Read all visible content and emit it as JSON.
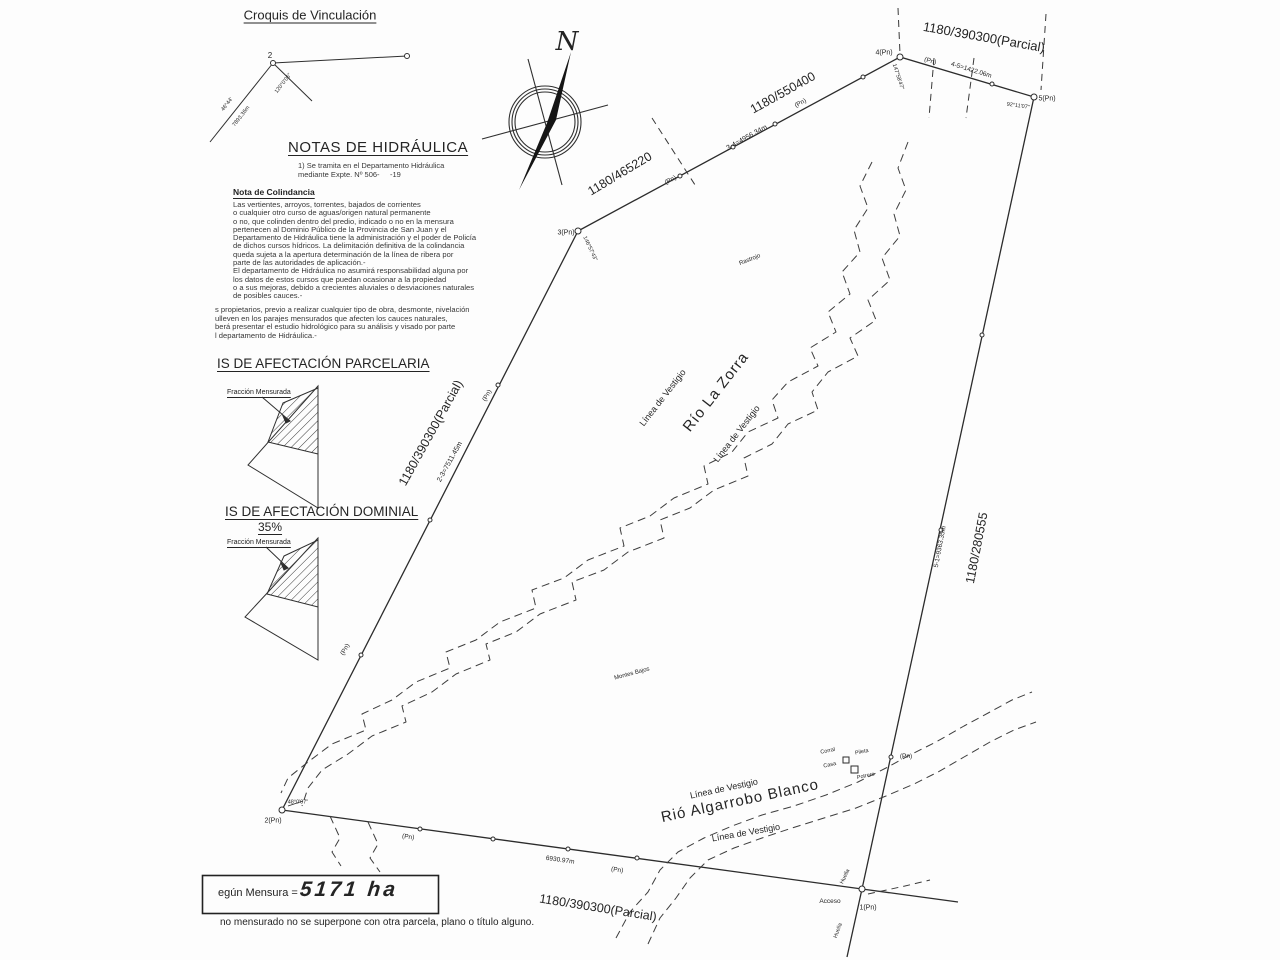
{
  "croquis": {
    "title": "Croquis de Vinculación",
    "vertex": "2",
    "angle_branch": "120°0'06\"",
    "angle_left": "46°44'",
    "distance": "7893.36m"
  },
  "notas": {
    "title": "NOTAS DE HIDRÁULICA",
    "item1": "1) Se tramita en el Departamento Hidráulica\nmediante Expte. Nº 506-     -19",
    "colindancia_title": "Nota de Colindancia",
    "paragraph1": "Las vertientes, arroyos, torrentes, bajados de corrientes\no cualquier otro curso de aguas/origen natural permanente\no no, que colinden dentro del predio, indicado o no en la mensura\npertenecen al Dominio Público de la Provincia de San Juan y el\nDepartamento de Hidráulica tiene la administración y el poder de Policía\nde dichos cursos hídricos. La delimitación definitiva de la colindancia\nqueda sujeta a la apertura determinación de la línea de ribera por\nparte de las autoridades de aplicación.-\nEl departamento de Hidráulica no asumirá responsabilidad alguna por\nlos datos de estos cursos que puedan ocasionar a la propiedad\no a sus mejoras, debido a crecientes aluviales o desviaciones naturales\nde posibles cauces.-",
    "paragraph2": "s propietarios, previo a realizar cualquier tipo de obra, desmonte, nivelación\nulleven en los parajes mensurados que afecten los cauces naturales,\nberá presentar el estudio hidrológico para su análisis y visado por parte\nl departamento de Hidráulica.-"
  },
  "parcelaria": {
    "title": "IS DE AFECTACIÓN PARCELARIA",
    "fraccion": "Fracción Mensurada"
  },
  "dominial": {
    "title": "IS DE AFECTACIÓN DOMINIAL",
    "percent": "35%",
    "fraccion": "Fracción Mensurada"
  },
  "mensura": {
    "label": "egún Mensura =",
    "value": "5171 ha"
  },
  "footer": {
    "note": "no mensurado no se superpone con otra parcela, plano o título alguno."
  },
  "compass": {
    "north": "N"
  },
  "plan": {
    "pn": "(Pn)",
    "parcels": {
      "left": "1180/390300(Parcial)",
      "adj1": "1180/465220",
      "adj2": "1180/550400",
      "top": "1180/390300(Parcial)",
      "right": "1180/280555",
      "bottom": "1180/390300(Parcial)"
    },
    "segments": {
      "s23": "2-3=7511.45m",
      "s34": "3-4=4956.34m",
      "s45": "4-5=1422.06m",
      "s51": "5-1=9363.35m",
      "s12": "6930.97m"
    },
    "vertices": {
      "v1": "1(Pn)",
      "v2": "2(Pn)",
      "v3": "3(Pn)",
      "v4": "4(Pn)",
      "v5": "5(Pn)"
    },
    "angles": {
      "a2": "48°0'07\"",
      "a3": "146°57'43\"",
      "a4": "147°58'47\"",
      "a5": "92°11'07\""
    },
    "features": {
      "vestigio": "Línea de Vestigio",
      "rio_zorra": "Río La Zorra",
      "rio_algarrobo": "Rió Algarrobo Blanco",
      "rastrojo": "Rastrojo",
      "montes_bajos": "Montes Bajos",
      "corral": "Corral",
      "pileta": "Pileta",
      "casa": "Casa",
      "potrero": "Potrero",
      "acceso": "Acceso",
      "huella": "Huella"
    }
  }
}
